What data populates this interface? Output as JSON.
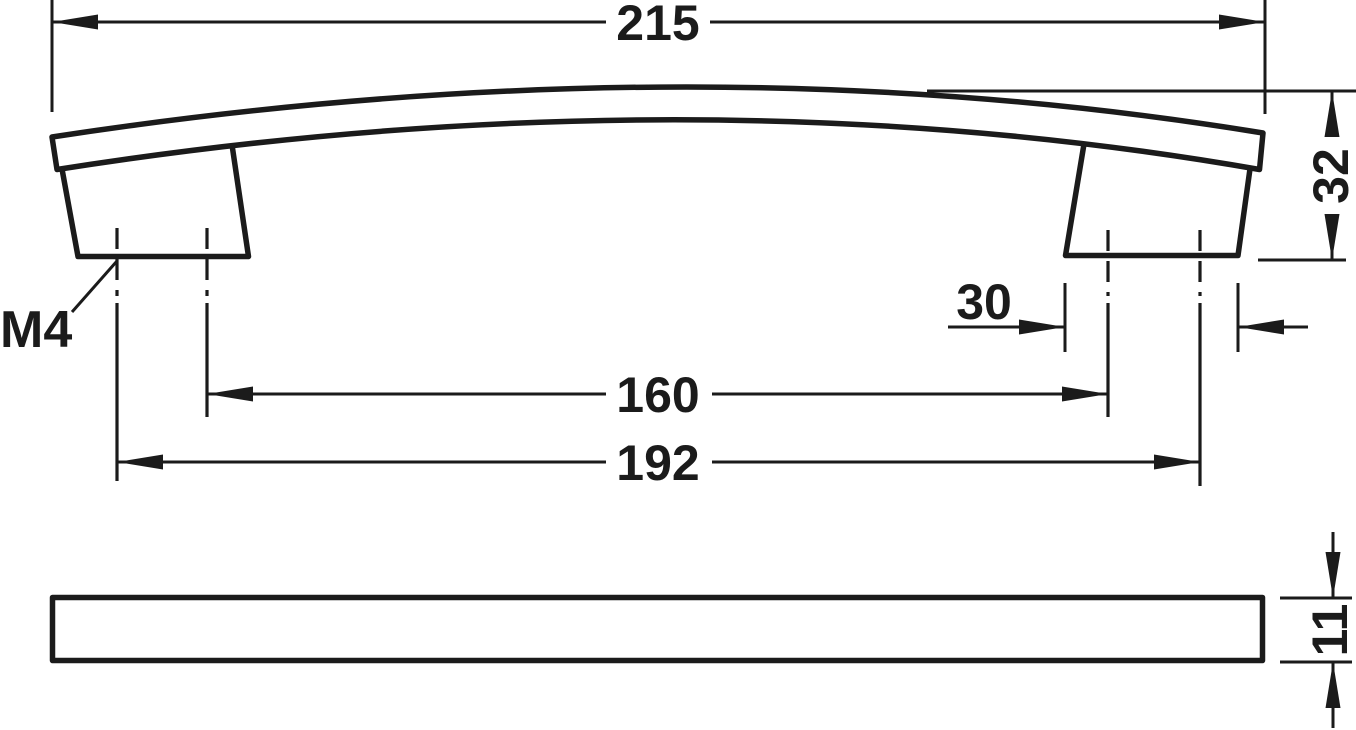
{
  "drawing": {
    "type": "technical-dimension-drawing",
    "subject": "arched furniture bow handle, side elevation and bottom profile view",
    "colors": {
      "line": "#1b1b1b",
      "background": "#ffffff"
    },
    "labels": {
      "overall_length": "215",
      "height": "32",
      "foot_width": "30",
      "hole_spacing_inner": "160",
      "hole_spacing_outer": "192",
      "profile_thickness": "11",
      "thread": "M4"
    }
  }
}
